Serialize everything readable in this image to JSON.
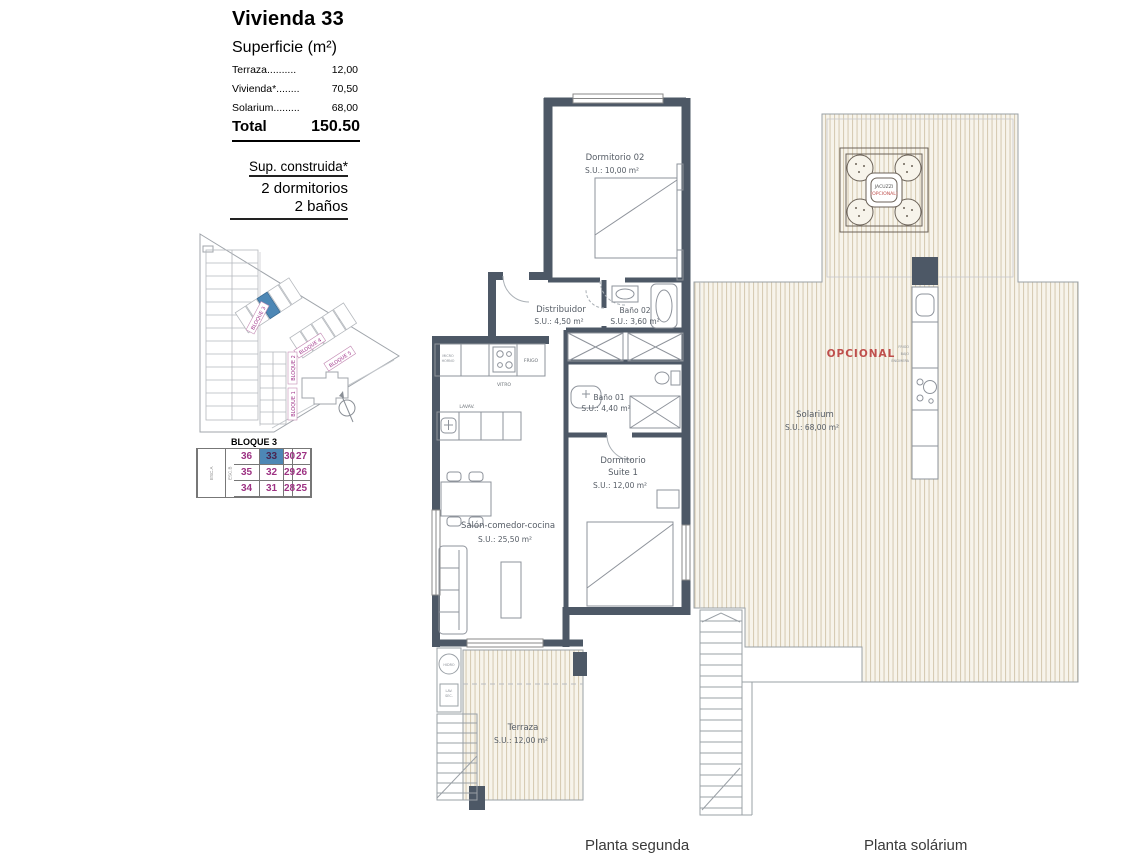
{
  "header": {
    "title": "Vivienda 33",
    "subtitle": "Superficie (m²)",
    "surface_rows": [
      {
        "label": "Terraza..........",
        "value": "12,00"
      },
      {
        "label": "Vivienda*........",
        "value": "70,50"
      },
      {
        "label": "Solarium.........",
        "value": "68,00"
      }
    ],
    "total_label": "Total",
    "total_value": "150.50",
    "built_title": "Sup. construida*",
    "built_line1": "2 dormitorios",
    "built_line2": "2 baños"
  },
  "site_plan": {
    "bloque1": "BLOQUE 1",
    "bloque2": "BLOQUE 2",
    "bloque3": "BLOQUE 3",
    "bloque4": "BLOQUE 4",
    "bloque5": "BLOQUE 5"
  },
  "unit_table": {
    "title": "BLOQUE 3",
    "esc_a": "ESC.A",
    "esc_b": "ESC.B",
    "rows": [
      [
        "36",
        "33",
        "30",
        "27"
      ],
      [
        "35",
        "32",
        "29",
        "26"
      ],
      [
        "34",
        "31",
        "28",
        "25"
      ]
    ],
    "highlighted_unit": "33"
  },
  "planta_segunda": {
    "caption": "Planta segunda",
    "dormitorio02": {
      "name": "Dormitorio 02",
      "area": "S.U.: 10,00 m²"
    },
    "distribuidor": {
      "name": "Distribuidor",
      "area": "S.U.: 4,50 m²"
    },
    "bano02": {
      "name": "Baño 02",
      "area": "S.U.: 3,60 m²"
    },
    "bano01": {
      "name": "Baño 01",
      "area": "S.U.: 4,40 m²"
    },
    "suite": {
      "name1": "Dormitorio",
      "name2": "Suite 1",
      "area": "S.U.: 12,00 m²"
    },
    "salon": {
      "name": "Salón-comedor-cocina",
      "area": "S.U.: 25,50 m²"
    },
    "terraza": {
      "name": "Terraza",
      "area": "S.U.: 12,00 m²"
    },
    "kitchen": {
      "micro1": "MICRO",
      "micro2": "HORNO",
      "vitro": "VITRO",
      "frigo": "FRIGO",
      "lavav": "LAVAV.",
      "hidro": "HIDRO",
      "lav1": "LAV.",
      "lav2": "SEC."
    }
  },
  "planta_solarium": {
    "caption": "Planta solárium",
    "solarium": {
      "name": "Solarium",
      "area": "S.U.: 68,00 m²"
    },
    "opcional": "OPCIONAL",
    "jacuzzi1": "JACUZZI",
    "jacuzzi2": "(OPCIONAL)",
    "frigo1": "FRIGO",
    "frigo2": "BAJO",
    "frigo3": "ENCIMERA"
  },
  "colors": {
    "wall": "#4d5866",
    "deck_stripe": "#d7ccb4",
    "deck_bg": "#f7f4eb",
    "magenta": "#a0338a",
    "highlight_blue": "#4d87b5",
    "red": "#bf4f4c"
  }
}
